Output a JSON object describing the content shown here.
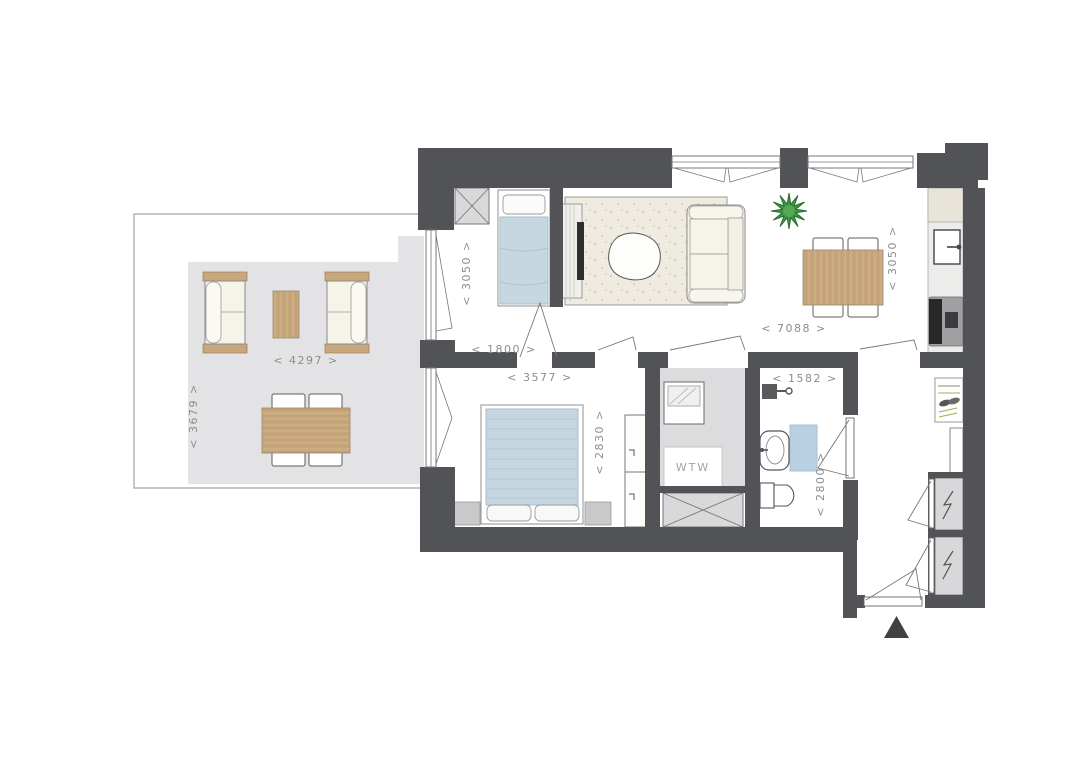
{
  "plan": {
    "kind": "apartment-floor-plan",
    "entrance_marker": "▲"
  },
  "labels": {
    "terrace_width": "< 4297 >",
    "terrace_depth": "< 3679 >",
    "bedroom1_depth": "< 3050 >",
    "bedroom1_width": "< 1800 >",
    "bedroom2_width": "< 3577 >",
    "bedroom2_depth": "< 2830 >",
    "living_width": "< 7088 >",
    "living_depth": "< 3050 >",
    "bathroom_width": "< 1582 >",
    "bathroom_depth": "< 2800 >",
    "wtw_label": "WTW"
  },
  "colors": {
    "wall": "#515356",
    "terrace_floor": "#e3e3e5",
    "wtw_floor": "#dcdcde",
    "shaft_fill": "#d9d9db",
    "rug": "#efebe0",
    "wood": "#c9a77d",
    "sofa_cream": "#f6f3e9",
    "bed_blue": "#c7d7e2",
    "bath_mat_blue": "#b9cfe2",
    "plant_green": "#3e9340",
    "dim_text": "#8c8c8c"
  },
  "rooms": [
    {
      "name": "terrace",
      "dimensions": [
        "< 4297 >",
        "< 3679 >"
      ]
    },
    {
      "name": "bedroom-1",
      "dimensions": [
        "< 1800 >",
        "< 3050 >"
      ]
    },
    {
      "name": "living-room-kitchen",
      "dimensions": [
        "< 7088 >",
        "< 3050 >"
      ]
    },
    {
      "name": "bedroom-2",
      "dimensions": [
        "< 3577 >",
        "< 2830 >"
      ]
    },
    {
      "name": "technical-room",
      "label": "WTW"
    },
    {
      "name": "bathroom",
      "dimensions": [
        "< 1582 >",
        "< 2800 >"
      ]
    },
    {
      "name": "entrance-hall"
    }
  ],
  "furniture_icons": [
    "terrace-sofa",
    "outdoor-coffee-table",
    "outdoor-dining-table",
    "outdoor-chair",
    "single-bed",
    "double-bed",
    "pillow",
    "nightstand",
    "wardrobe",
    "tv-cabinet",
    "tv",
    "rug",
    "organic-coffee-table",
    "sofa",
    "plant",
    "dining-table",
    "chair",
    "kitchen-counter",
    "kitchen-sink",
    "stove",
    "washing-machine",
    "shower",
    "bathroom-sink",
    "bath-mat",
    "toilet",
    "coat-rack",
    "tall-cabinet",
    "meter-closet-lightning",
    "duct-shaft-x",
    "entrance-door",
    "window",
    "door-swing",
    "entrance-triangle"
  ]
}
